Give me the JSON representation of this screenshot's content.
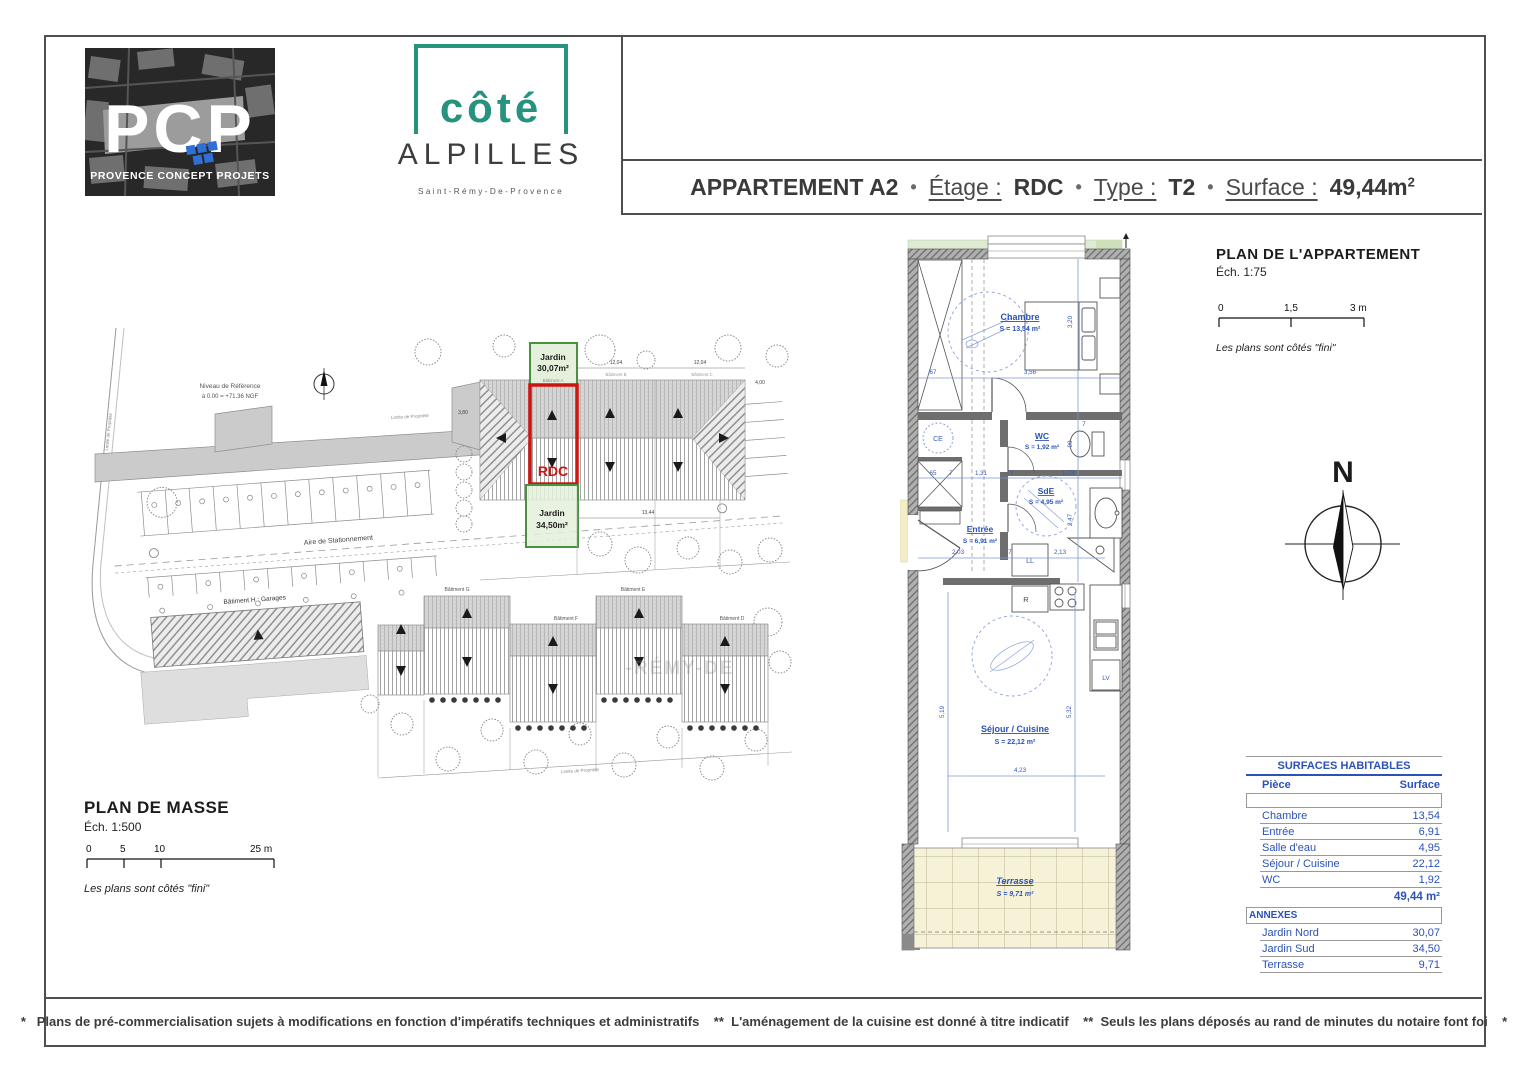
{
  "logos": {
    "pcp": {
      "letters": "PCP",
      "subtitle": "PROVENCE CONCEPT PROJETS"
    },
    "cote": {
      "top": "côté",
      "bottom": "ALPILLES",
      "subtitle": "Saint-Rémy-De-Provence"
    }
  },
  "title_bar": {
    "name": "APPARTEMENT A2",
    "sep": "•",
    "etage_label": "Étage :",
    "etage_value": "RDC",
    "type_label": "Type :",
    "type_value": "T2",
    "surface_label": "Surface :",
    "surface_value": "49,44m",
    "surface_exp": "2"
  },
  "site_plan": {
    "caption": {
      "title": "PLAN DE MASSE",
      "scale": "Éch. 1:500",
      "ticks": [
        "0",
        "5",
        "10",
        "25 m"
      ],
      "note": "Les plans sont côtés \"fini\""
    },
    "labels": {
      "niveau_line1": "Niveau de Référence",
      "niveau_line2": "à 0.00 = +71.36 NGF",
      "aire": "Aire de Stationnement",
      "bat_h": "Bâtiment H : Garages",
      "bat_g": "Bâtiment G",
      "bat_f": "Bâtiment F",
      "bat_e": "Bâtiment E",
      "bat_d": "Bâtiment D",
      "bat_a": "Bâtiment A",
      "bat_b": "Bâtiment B",
      "bat_c": "Bâtiment C",
      "jardin_nord_l1": "Jardin",
      "jardin_nord_l2": "30,07m²",
      "rdc": "RDC",
      "jardin_sud_l1": "Jardin",
      "jardin_sud_l2": "34,50m²",
      "limite": "Limite de Propriété",
      "dim_380": "3,80",
      "dim_1204a": "12,04",
      "dim_1204b": "12,04",
      "dim_1344": "13,44",
      "dim_400": "4,00"
    },
    "watermark": "-RÉMY-DE"
  },
  "apartment_plan": {
    "caption": {
      "title": "PLAN DE L'APPARTEMENT",
      "scale": "Éch. 1:75",
      "ticks": [
        "0",
        "1,5",
        "3 m"
      ],
      "note": "Les plans sont côtés \"fini\""
    },
    "rooms": {
      "chambre": {
        "name": "Chambre",
        "area": "S = 13,54 m²"
      },
      "wc": {
        "name": "WC",
        "area": "S = 1,92 m²"
      },
      "sde": {
        "name": "SdE",
        "area": "S = 4,95 m²"
      },
      "entree": {
        "name": "Entrée",
        "area": "S = 6,91 m²"
      },
      "sejour": {
        "name": "Séjour / Cuisine",
        "area": "S = 22,12 m²"
      },
      "terrasse": {
        "name": "Terrasse",
        "area": "S = 9,71 m²"
      }
    },
    "appliances": {
      "ce": "CE",
      "ll": "LL",
      "r": "R",
      "lv": "LV"
    },
    "dims": {
      "d67": "67",
      "d356": "3,56",
      "d320": "3,20",
      "d7a": "7",
      "d90": "90",
      "d65": "65",
      "d7b": "7",
      "d131": "1,31",
      "d7c": "7",
      "d173": "1,73",
      "d247": "2,47",
      "d203": "2,03",
      "d7d": "7",
      "d213": "2,13",
      "d519": "5,19",
      "d532": "5,32",
      "d423": "4,23"
    }
  },
  "compass": {
    "n": "N"
  },
  "surfaces_table": {
    "title": "SURFACES HABITABLES",
    "col_piece": "Pièce",
    "col_surface": "Surface",
    "rows": [
      {
        "piece": "Chambre",
        "surface": "13,54"
      },
      {
        "piece": "Entrée",
        "surface": "6,91"
      },
      {
        "piece": "Salle d'eau",
        "surface": "4,95"
      },
      {
        "piece": "Séjour / Cuisine",
        "surface": "22,12"
      },
      {
        "piece": "WC",
        "surface": "1,92"
      }
    ],
    "total": "49,44 m²",
    "annexes_title": "ANNEXES",
    "annexes": [
      {
        "piece": "Jardin Nord",
        "surface": "30,07"
      },
      {
        "piece": "Jardin Sud",
        "surface": "34,50"
      },
      {
        "piece": "Terrasse",
        "surface": "9,71"
      }
    ]
  },
  "footer": {
    "text": "*   Plans de pré-commercialisation sujets à modifications en fonction d'impératifs techniques et administratifs    **  L'aménagement de la cuisine est donné à titre indicatif    **  Seuls les plans déposés au rand de minutes du notaire font foi    *"
  }
}
